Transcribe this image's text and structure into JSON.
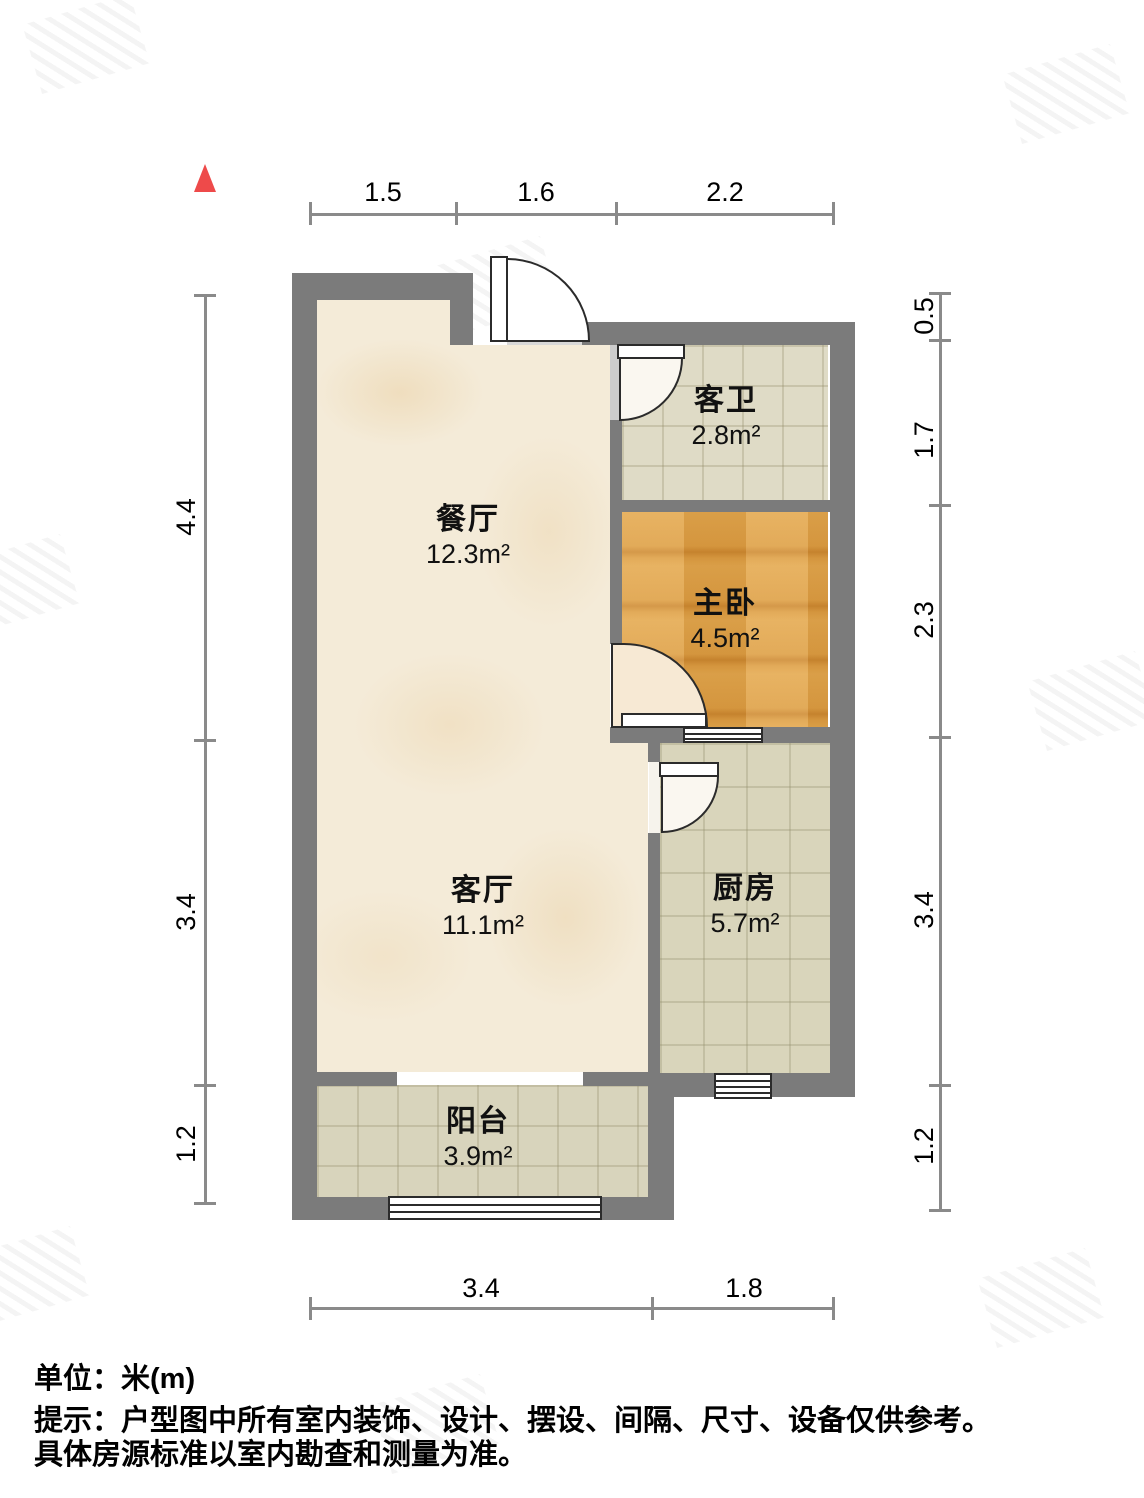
{
  "rooms": [
    {
      "id": "dining",
      "name": "餐厅",
      "area": "12.3m²"
    },
    {
      "id": "guest-bath",
      "name": "客卫",
      "area": "2.8m²"
    },
    {
      "id": "master-bedroom",
      "name": "主卧",
      "area": "4.5m²"
    },
    {
      "id": "living",
      "name": "客厅",
      "area": "11.1m²"
    },
    {
      "id": "kitchen",
      "name": "厨房",
      "area": "5.7m²"
    },
    {
      "id": "balcony",
      "name": "阳台",
      "area": "3.9m²"
    }
  ],
  "dimensions": {
    "top": [
      "1.5",
      "1.6",
      "2.2"
    ],
    "left": [
      "4.4",
      "3.4",
      "1.2"
    ],
    "right": [
      "0.5",
      "1.7",
      "2.3",
      "3.4",
      "1.2"
    ],
    "bottom": [
      "3.4",
      "1.8"
    ]
  },
  "footer": {
    "line1": "单位：米(m)",
    "line2": "提示：户型图中所有室内装饰、设计、摆设、间隔、尺寸、设备仅供参考。",
    "line3": "具体房源标准以室内勘查和测量为准。"
  },
  "colors": {
    "wall": "#7b7b7b",
    "north_arrow": "#ee4a4a",
    "marble_floor": "#f4ebd8",
    "tile_floor": "#dcd8c2",
    "wood_floor": "#dfa04a",
    "dimension_line": "#8a8a8a"
  }
}
